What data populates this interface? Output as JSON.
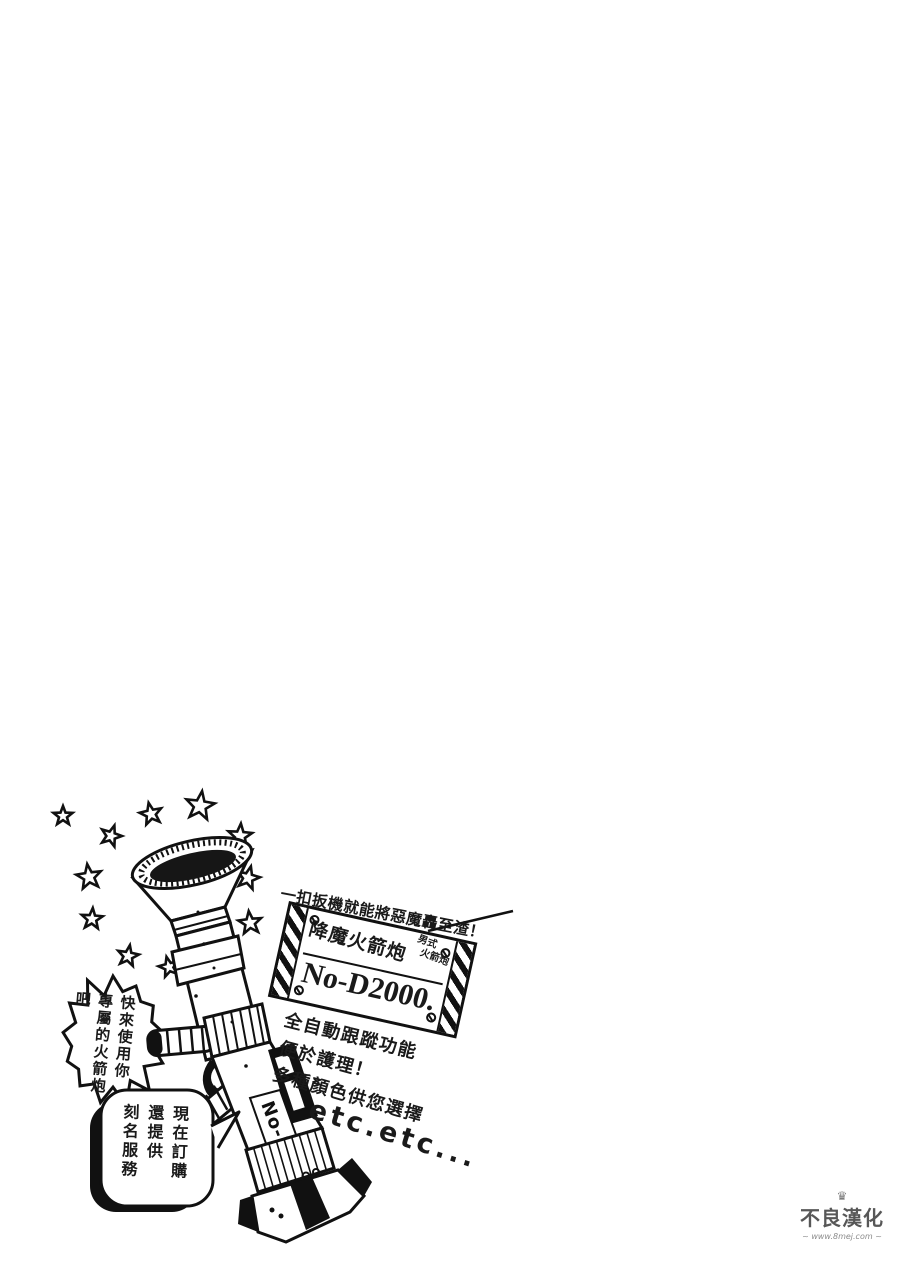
{
  "colors": {
    "ink": "#1a1a1a",
    "paper": "#ffffff",
    "watermark_gray": "#555555"
  },
  "ad": {
    "headline": "一扣扳機就能將惡魔轟至渣！",
    "sign": {
      "product_name": "降魔火箭炮",
      "category_line1": "男式",
      "category_line2": "火箭炮",
      "model": "No-D2000."
    },
    "features": [
      "全自動跟蹤功能",
      "便於護理！",
      "多種顏色供您選擇"
    ],
    "etc_text": "etc.etc...",
    "burst_bubble_text": "快來使用你\n專屬的火箭炮吧",
    "order_bubble_text": "現在訂購\n還提供\n刻名服務",
    "launcher_label": "No-D"
  },
  "watermark": {
    "group_name": "不良漢化",
    "url_text": "www.8mej.com"
  }
}
